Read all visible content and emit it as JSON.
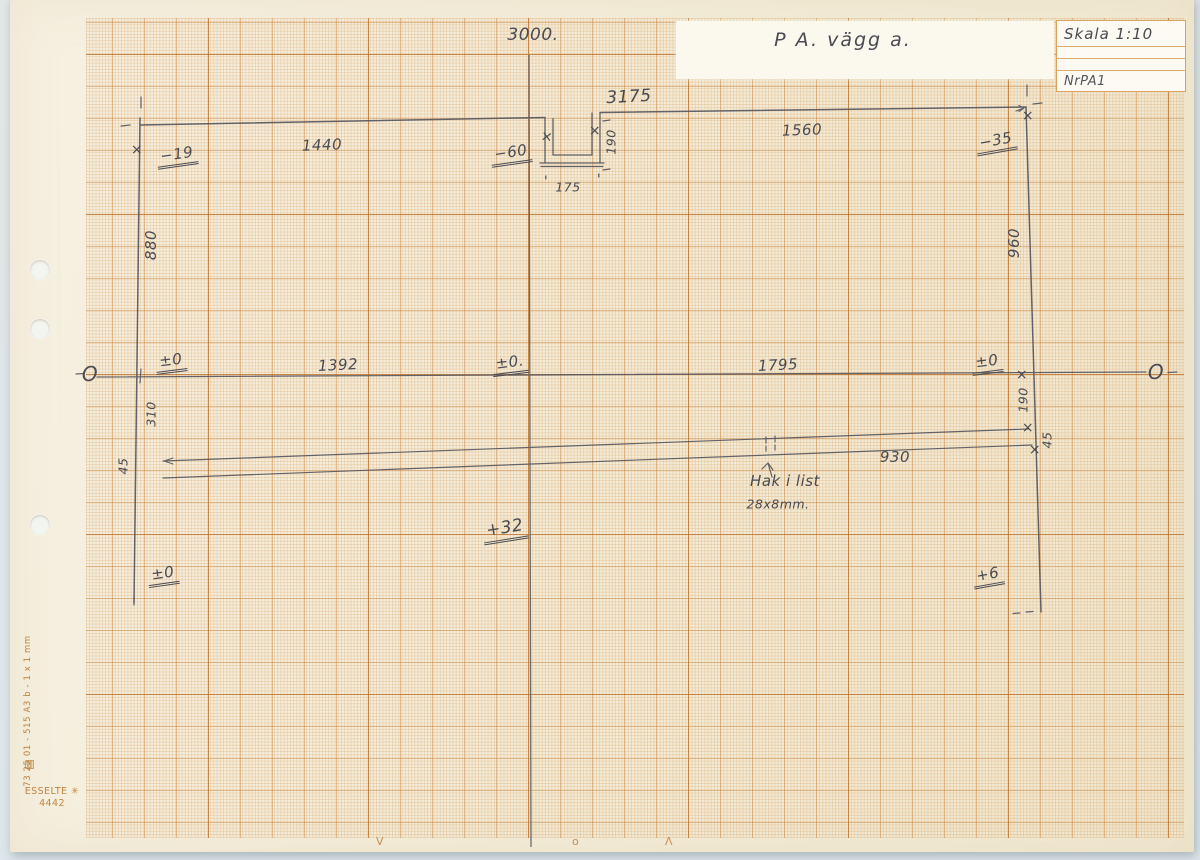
{
  "colors": {
    "paper": "#f3ecd8",
    "grid_orange": "#c98a4a",
    "pencil": "#4a4a52",
    "margin_print": "#c08038",
    "background": "#e0e7ea"
  },
  "title_block": {
    "scale": "Skala 1:10",
    "sheet_no": "NrPA1"
  },
  "paper_margin": {
    "product_code": "73 25 01 - 515 A3 b - 1 x 1 mm",
    "logo_glyph": "▤",
    "brand": "ESSELTE ✳",
    "brand_number": "4442",
    "bottom_marks": [
      "V",
      "o",
      "Λ"
    ]
  },
  "annotations": [
    {
      "name": "top-dimension",
      "text": "3000.",
      "x": 533,
      "y": 35,
      "cls": "lg",
      "rot": 0
    },
    {
      "name": "drawing-title",
      "text": "P A. vägg a.",
      "x": 843,
      "y": 40,
      "cls": "title",
      "rot": 0
    },
    {
      "name": "dim-3175",
      "text": "3175",
      "x": 629,
      "y": 97,
      "cls": "lg",
      "rot": -3
    },
    {
      "name": "dim-1440",
      "text": "1440",
      "x": 322,
      "y": 145,
      "cls": "",
      "rot": -2
    },
    {
      "name": "level-minus19",
      "text": "−19",
      "x": 177,
      "y": 156,
      "cls": "lvl",
      "rot": -8
    },
    {
      "name": "level-minus60",
      "text": "−60",
      "x": 511,
      "y": 154,
      "cls": "lvl",
      "rot": -8
    },
    {
      "name": "dim-175",
      "text": "175",
      "x": 568,
      "y": 187,
      "cls": "sm",
      "rot": 0
    },
    {
      "name": "dim-190-notch",
      "text": "190",
      "x": 611,
      "y": 142,
      "cls": "sm",
      "rot": -90
    },
    {
      "name": "dim-1560",
      "text": "1560",
      "x": 802,
      "y": 130,
      "cls": "",
      "rot": -2
    },
    {
      "name": "level-minus35",
      "text": "−35",
      "x": 996,
      "y": 142,
      "cls": "lvl",
      "rot": -10
    },
    {
      "name": "dim-880",
      "text": "880",
      "x": 151,
      "y": 245,
      "cls": "",
      "rot": -90
    },
    {
      "name": "dim-960",
      "text": "960",
      "x": 1014,
      "y": 243,
      "cls": "",
      "rot": -90
    },
    {
      "name": "datum-circle-left",
      "text": "O",
      "x": 90,
      "y": 374,
      "cls": "datum",
      "rot": 0
    },
    {
      "name": "level-pm0-left",
      "text": "±0",
      "x": 171,
      "y": 362,
      "cls": "lvl",
      "rot": -7
    },
    {
      "name": "dim-1392",
      "text": "1392",
      "x": 338,
      "y": 365,
      "cls": "",
      "rot": -3
    },
    {
      "name": "level-pm0-mid",
      "text": "±0.",
      "x": 510,
      "y": 364,
      "cls": "lvl",
      "rot": -7
    },
    {
      "name": "dim-1795",
      "text": "1795",
      "x": 778,
      "y": 365,
      "cls": "",
      "rot": -3
    },
    {
      "name": "level-pm0-right",
      "text": "±0",
      "x": 987,
      "y": 363,
      "cls": "lvl",
      "rot": -7
    },
    {
      "name": "datum-circle-right",
      "text": "O",
      "x": 1156,
      "y": 372,
      "cls": "datum",
      "rot": 0
    },
    {
      "name": "dim-310",
      "text": "310",
      "x": 151,
      "y": 414,
      "cls": "sm",
      "rot": -90
    },
    {
      "name": "dim-190-right",
      "text": "190",
      "x": 1023,
      "y": 400,
      "cls": "sm",
      "rot": -90
    },
    {
      "name": "dim-45-left",
      "text": "45",
      "x": 123,
      "y": 466,
      "cls": "sm",
      "rot": -90
    },
    {
      "name": "dim-45-right",
      "text": "45",
      "x": 1047,
      "y": 440,
      "cls": "sm",
      "rot": -90
    },
    {
      "name": "dim-930",
      "text": "930",
      "x": 895,
      "y": 457,
      "cls": "",
      "rot": 0
    },
    {
      "name": "note-hak-i-list",
      "text": "Hak i list",
      "x": 785,
      "y": 481,
      "cls": "",
      "rot": 0
    },
    {
      "name": "note-hak-size",
      "text": "28x8mm.",
      "x": 778,
      "y": 504,
      "cls": "sm",
      "rot": 0
    },
    {
      "name": "level-plus32",
      "text": "+32",
      "x": 505,
      "y": 530,
      "cls": "lvl lg",
      "rot": -9
    },
    {
      "name": "level-pm0-bottom",
      "text": "±0",
      "x": 163,
      "y": 575,
      "cls": "lvl",
      "rot": -8
    },
    {
      "name": "level-plus6",
      "text": "+6",
      "x": 988,
      "y": 576,
      "cls": "lvl",
      "rot": -10
    },
    {
      "name": "x-mark",
      "text": "×",
      "x": 137,
      "y": 150,
      "cls": "xm",
      "rot": 0
    },
    {
      "name": "x-mark",
      "text": "×",
      "x": 547,
      "y": 137,
      "cls": "xm",
      "rot": 8
    },
    {
      "name": "x-mark",
      "text": "×",
      "x": 595,
      "y": 131,
      "cls": "xm",
      "rot": 0
    },
    {
      "name": "x-mark",
      "text": "×",
      "x": 1028,
      "y": 116,
      "cls": "xm",
      "rot": 0
    },
    {
      "name": "x-mark",
      "text": "×",
      "x": 1022,
      "y": 375,
      "cls": "xm xs",
      "rot": 0
    },
    {
      "name": "x-mark",
      "text": "×",
      "x": 1028,
      "y": 428,
      "cls": "xm",
      "rot": 0
    },
    {
      "name": "x-mark",
      "text": "×",
      "x": 1035,
      "y": 450,
      "cls": "xm xs",
      "rot": 0
    },
    {
      "name": "tick-quote",
      "text": "'",
      "x": 546,
      "y": 182,
      "cls": "q",
      "rot": 0
    },
    {
      "name": "tick-quote",
      "text": "'",
      "x": 599,
      "y": 180,
      "cls": "q",
      "rot": 0
    }
  ]
}
